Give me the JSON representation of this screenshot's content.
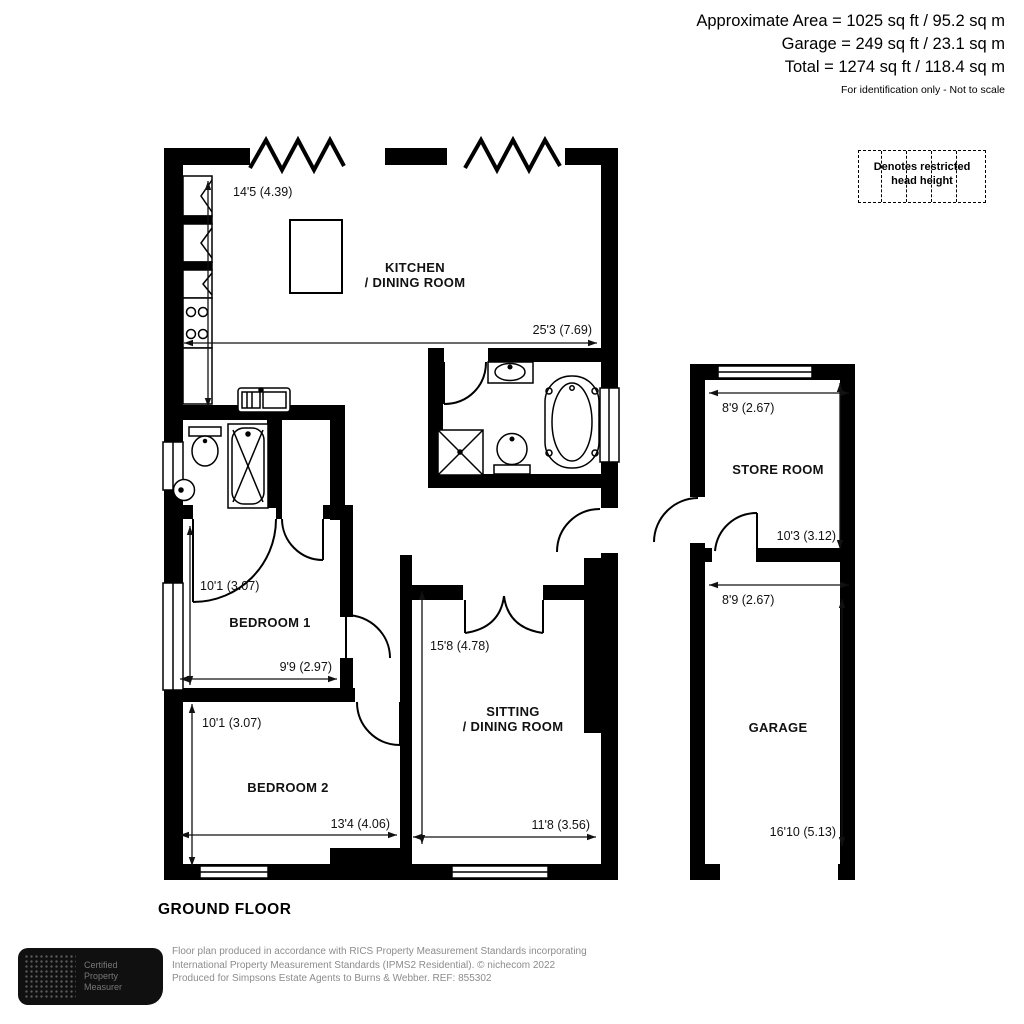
{
  "header": {
    "area_line": "Approximate Area = 1025 sq ft / 95.2 sq m",
    "garage_line": "Garage = 249 sq ft / 23.1 sq m",
    "total_line": "Total = 1274 sq ft / 118.4 sq m",
    "note": "For identification only - Not to scale"
  },
  "legend": {
    "line1": "Denotes restricted",
    "line2": "head height"
  },
  "floor_label": "GROUND FLOOR",
  "rooms": {
    "kitchen": {
      "line1": "KITCHEN",
      "line2": "/ DINING ROOM"
    },
    "sitting": {
      "line1": "SITTING",
      "line2": "/ DINING ROOM"
    },
    "bedroom1": {
      "label": "BEDROOM 1"
    },
    "bedroom2": {
      "label": "BEDROOM 2"
    },
    "store": {
      "label": "STORE ROOM"
    },
    "garage": {
      "label": "GARAGE"
    }
  },
  "dimensions": {
    "kitchen_v": "14'5 (4.39)",
    "kitchen_h": "25'3 (7.69)",
    "bedroom1_v": "10'1 (3.07)",
    "bedroom1_h": "9'9 (2.97)",
    "bedroom2_v": "10'1 (3.07)",
    "bedroom2_h": "13'4 (4.06)",
    "sitting_v": "15'8 (4.78)",
    "sitting_h": "11'8 (3.56)",
    "store_h": "8'9 (2.67)",
    "store_v": "10'3 (3.12)",
    "garage_h": "8'9 (2.67)",
    "garage_v": "16'10 (5.13)"
  },
  "footer": {
    "logo_line1": "Certified",
    "logo_line2": "Property",
    "logo_line3": "Measurer",
    "line1": "Floor plan produced in accordance with RICS Property Measurement Standards incorporating",
    "line2": "International Property Measurement Standards (IPMS2 Residential).  © nichecom 2022",
    "line3": "Produced for Simpsons Estate Agents to Burns & Webber.  REF: 855302"
  },
  "colors": {
    "wall": "#000000",
    "dimension_text": "#111111",
    "footer_text": "#8c8c8c"
  }
}
